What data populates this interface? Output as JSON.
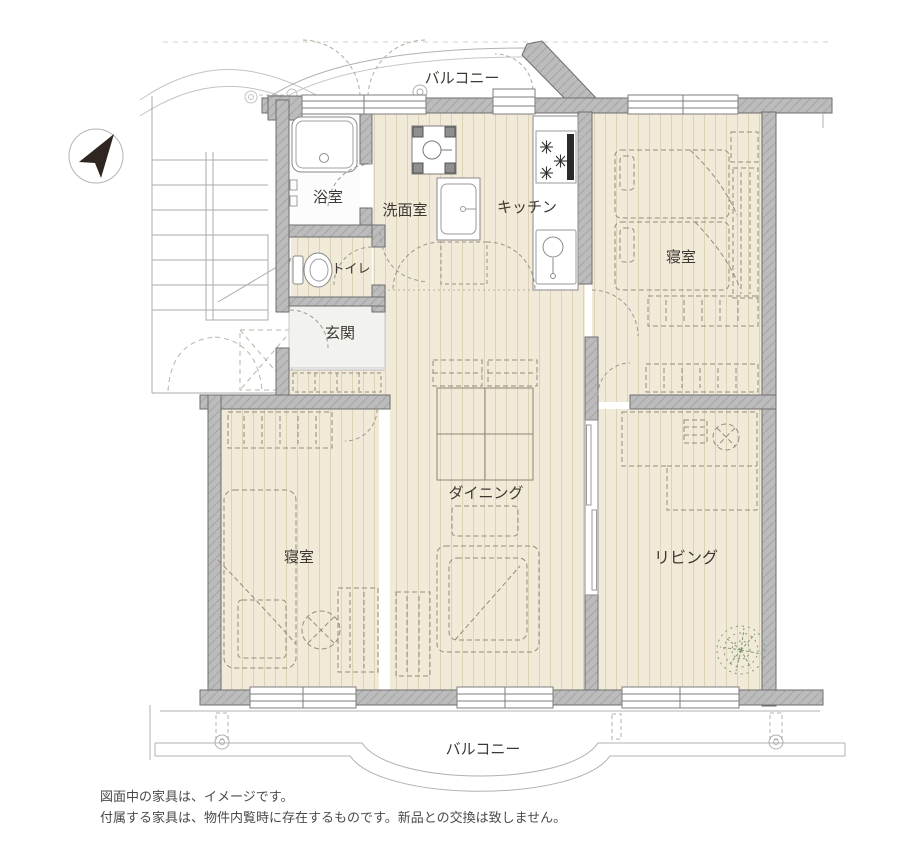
{
  "floorplan": {
    "rooms": {
      "balcony_top": "バルコニー",
      "bath": "浴室",
      "washroom": "洗面室",
      "kitchen": "キッチン",
      "toilet": "トイレ",
      "entrance": "玄関",
      "bedroom_right": "寝室",
      "bedroom_left": "寝室",
      "dining": "ダイニング",
      "living": "リビング",
      "balcony_bottom": "バルコニー"
    },
    "compass": "north-east-arrow"
  },
  "disclaimer": {
    "line1": "図面中の家具は、イメージです。",
    "line2": "付属する家具は、物件内覧時に存在するものです。新品との交換は致しません。"
  },
  "colors": {
    "background": "#ffffff",
    "floor": "#f1ead8",
    "floor_stripe": "#dcd2b6",
    "wall": "#bcbcbc",
    "wall_edge": "#6e6e6e",
    "line": "#9a9a9a",
    "furniture": "#948c7c",
    "text": "#3e3833",
    "plant": "#7f9a72",
    "entrance_floor": "#f2f2ef"
  }
}
